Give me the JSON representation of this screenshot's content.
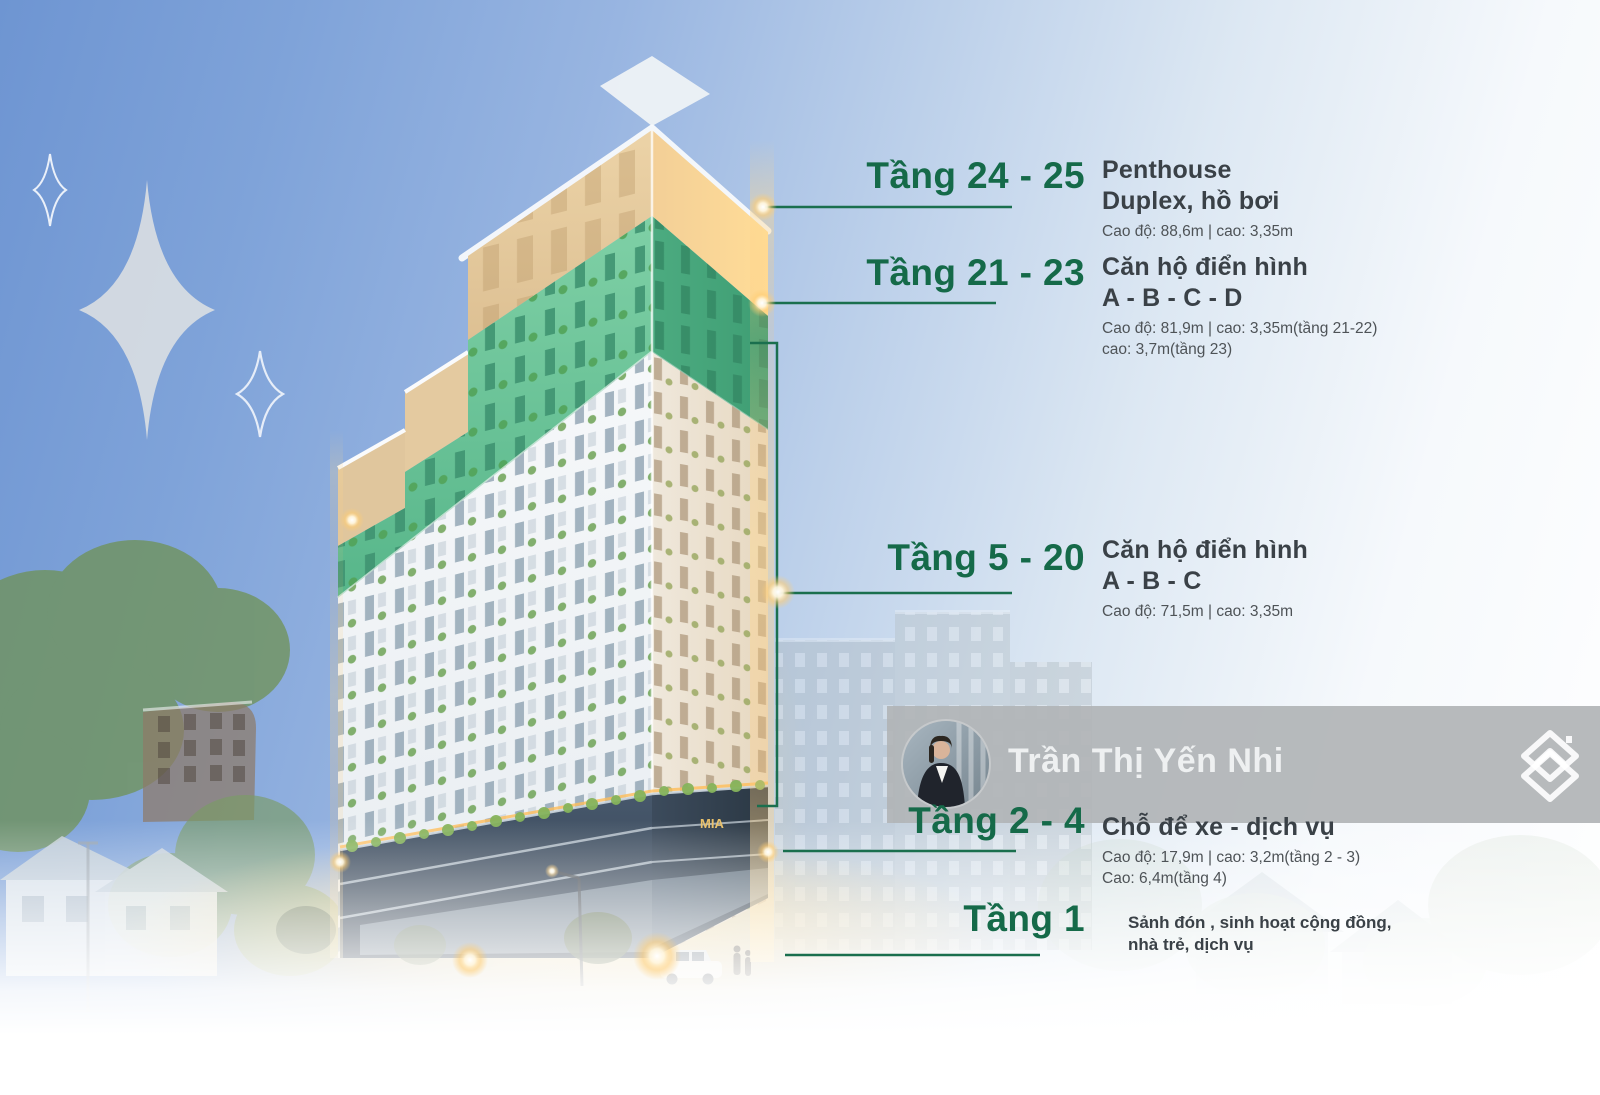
{
  "agent": {
    "name": "Trần Thị Yến Nhi",
    "avatar": "agent-photo"
  },
  "logo": {
    "icon": "house-chevrons-icon",
    "color": "#ffffff"
  },
  "building": {
    "sign": "MIA"
  },
  "palette": {
    "accent_green": "#1a6f4e",
    "heading_green": "#156a49",
    "title_text": "#3a4147",
    "detail_text": "#4e5357",
    "band_gray": "#b1b4b6",
    "glow_gold": "#ffd98f",
    "sky_blue": "#6e95d2",
    "facade_green": "#5cb88d",
    "crown_tan": "#e9cfa3",
    "podium_slate": "#3e4e60"
  },
  "floors": [
    {
      "label": "Tầng 24 - 25",
      "title_lines": [
        "Penthouse",
        "Duplex, hồ bơi"
      ],
      "details": [
        "Cao độ: 88,6m |  cao: 3,35m"
      ]
    },
    {
      "label": "Tầng 21 - 23",
      "title_lines": [
        "Căn hộ điển hình",
        "A - B - C - D"
      ],
      "details": [
        "Cao độ: 81,9m |  cao: 3,35m(tầng 21-22)",
        "cao: 3,7m(tầng 23)"
      ]
    },
    {
      "label": "Tầng 5 - 20",
      "title_lines": [
        "Căn hộ điển hình",
        "A - B - C"
      ],
      "details": [
        "Cao độ: 71,5m |  cao: 3,35m"
      ]
    },
    {
      "label": "Tầng 2 - 4",
      "title_lines": [
        "Chỗ để xe - dịch vụ"
      ],
      "details": [
        "Cao độ: 17,9m |  cao: 3,2m(tầng 2 - 3)",
        "Cao: 6,4m(tầng 4)"
      ]
    },
    {
      "label": "Tầng 1",
      "title_lines": [],
      "details": [
        "Sảnh đón , sinh hoạt cộng đồng,",
        "nhà trẻ, dịch vụ"
      ]
    }
  ]
}
